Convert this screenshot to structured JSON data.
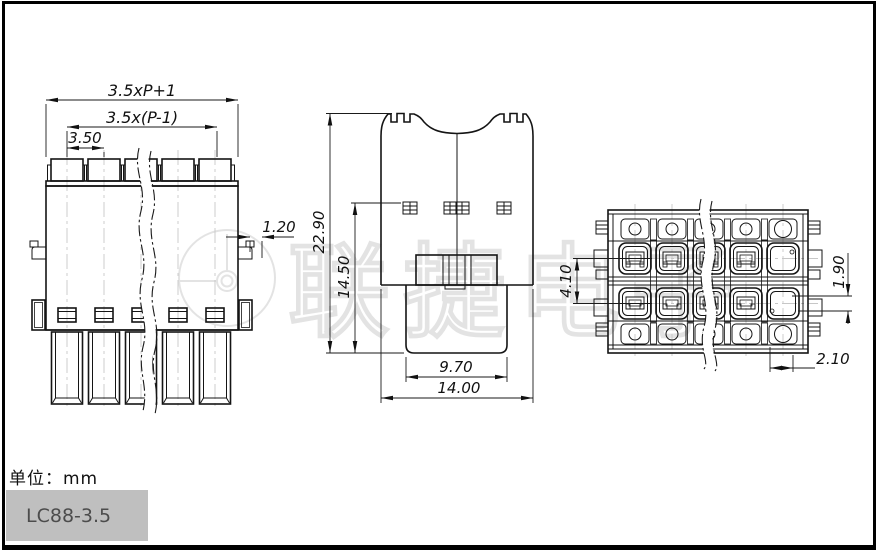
{
  "drawing": {
    "front_view": {
      "dim_overall": "3.5xP+1",
      "dim_span": "3.5x(P-1)",
      "dim_pitch": "3.50",
      "dim_wall": "1.20"
    },
    "side_view": {
      "dim_total_height": "22.90",
      "dim_body_height": "14.50",
      "dim_plug_width": "9.70",
      "dim_overall_width": "14.00"
    },
    "top_view": {
      "dim_row_pitch": "4.10",
      "dim_slot": "1.90",
      "dim_edge": "2.10"
    }
  },
  "watermark": {
    "text": "联捷电子"
  },
  "footer": {
    "unit_label": "单位：mm",
    "part_number": "LC88-3.5"
  }
}
